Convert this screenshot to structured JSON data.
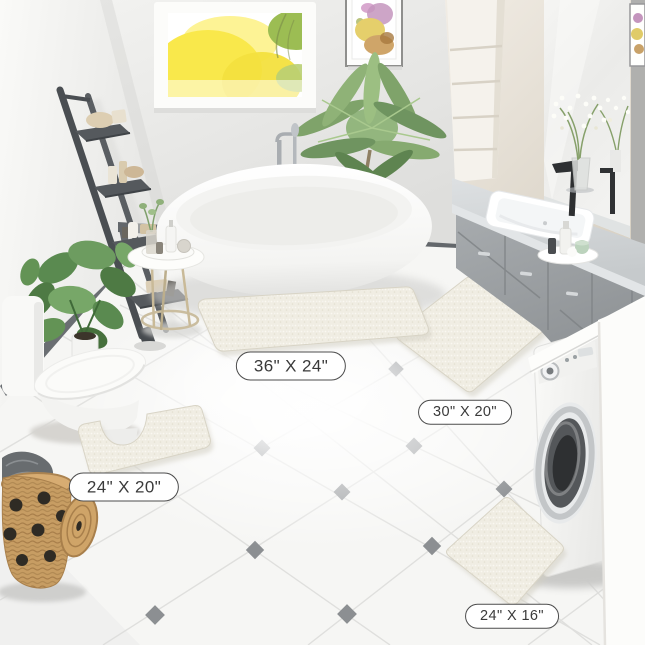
{
  "image": {
    "kind": "product-scene-photo",
    "description": "Bathroom scene showing four white chenille bath rugs in different sizes"
  },
  "size_labels": {
    "rug_36x24": "36\" X 24\"",
    "rug_30x20": "30\" X 20\"",
    "rug_24x20": "24\" X 20\"",
    "rug_24x16": "24\" X 16\""
  },
  "colors": {
    "rug": "#f0ede3",
    "label_border": "#4c4c4c",
    "label_text": "#3a3a3a",
    "floor_diamond": "#8c8f92",
    "vanity_cabinet": "#9aa0a3",
    "ladder": "#4a4e52",
    "basket": "#c79d63",
    "window_foliage_yellow": "#f9e84b",
    "plant_green": "#6d9c60"
  }
}
